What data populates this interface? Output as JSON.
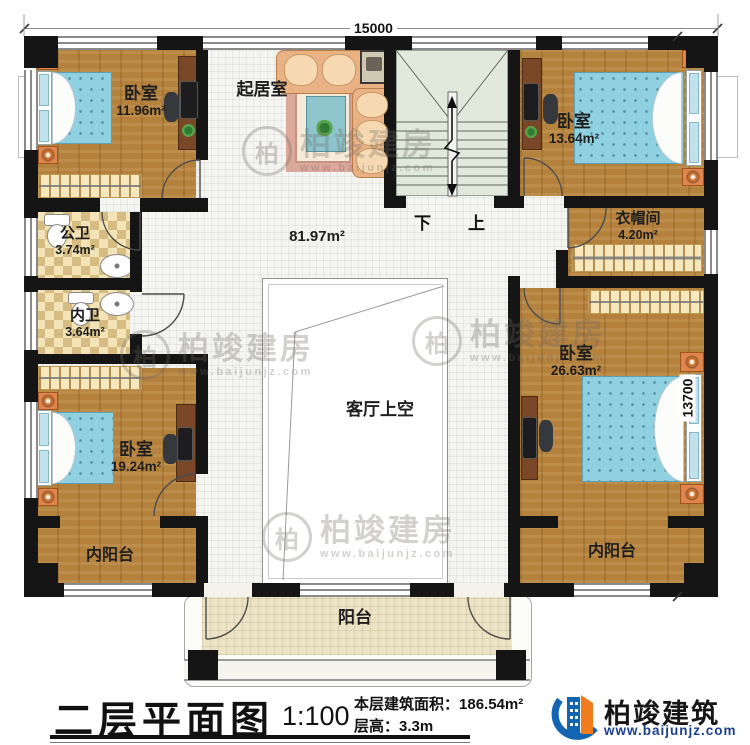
{
  "plan": {
    "dims": {
      "top": "15000",
      "right": "13700"
    },
    "stairs": {
      "down": "下",
      "up": "上"
    },
    "rooms": {
      "bedroom_tl": {
        "name": "卧室",
        "area": "11.96m²"
      },
      "living": {
        "name": "起居室"
      },
      "bedroom_tr": {
        "name": "卧室",
        "area": "13.64m²"
      },
      "cloakroom": {
        "name": "衣帽间",
        "area": "4.20m²"
      },
      "bath_public": {
        "name": "公卫",
        "area": "3.74m²"
      },
      "bath_private": {
        "name": "内卫",
        "area": "3.64m²"
      },
      "hall_area": "81.97m²",
      "bedroom_r": {
        "name": "卧室",
        "area": "26.63m²"
      },
      "bedroom_bl": {
        "name": "卧室",
        "area": "19.24m²"
      },
      "void_label": "客厅上空",
      "inner_balcony_left": "内阳台",
      "inner_balcony_right": "内阳台",
      "balcony": "阳台"
    }
  },
  "watermark": {
    "logo_char": "柏",
    "brand": "柏竣建房",
    "site": "www.baijunjz.com"
  },
  "titleblock": {
    "title": "二层平面图",
    "scale": "1:100",
    "area_label": "本层建筑面积：",
    "area_value": "186.54m²",
    "height_label": "层高：",
    "height_value": "3.3m",
    "brand_name": "柏竣建筑",
    "brand_site": "www.baijunjz.com"
  },
  "colors": {
    "wall": "#151515",
    "wood": "#b5823e",
    "tile": "#f4f4f1",
    "stairs": "#e1e8dc",
    "bath": "#f2e4b6",
    "balcony": "#ece3c6",
    "mattress": "#8fd0e1",
    "nightstand": "#e0854b",
    "logo_blue": "#1464b4",
    "logo_orange": "#f07c1e"
  }
}
